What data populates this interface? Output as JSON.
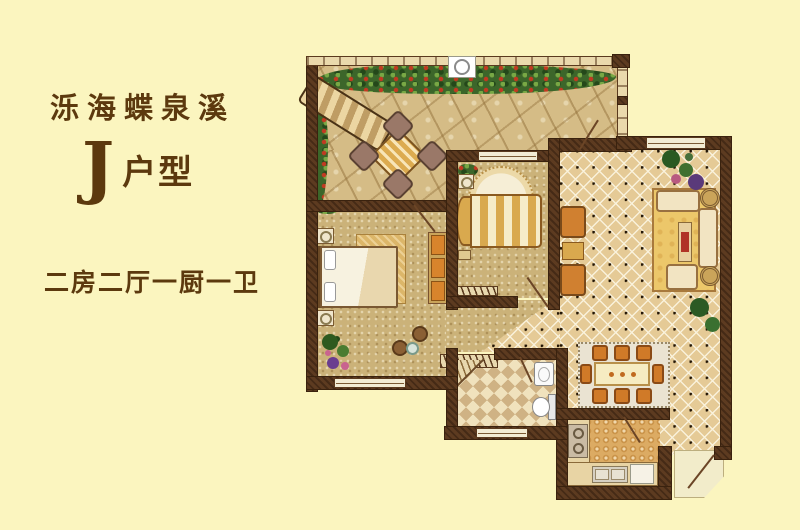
{
  "panel": {
    "project_name": "泺海蝶泉溪",
    "unit_letter": "J",
    "unit_suffix": "户型",
    "description": "二房二厅一厨一卫"
  },
  "colors": {
    "background": "#fbf5bf",
    "text": "#5c390e",
    "wall": "#5d3b20",
    "terrace_floor": "#d5bc86",
    "bedroom_floor": "#cbb279",
    "living_tile": "#e5ca96",
    "bathroom_tile_dark": "#cfb284",
    "bathroom_tile_light": "#f0e2bd",
    "kitchen_floor": "#dcab63",
    "hedge_green": "#3c662a",
    "flower_red": "#c23a22",
    "furniture_gold": "#d9a94e",
    "chair_orange": "#d07a28",
    "rug_red_accent": "#b03226",
    "plant_purple": "#6a3d8f",
    "plant_pink": "#c9648f"
  },
  "floorplan": {
    "rooms": [
      {
        "id": "terrace"
      },
      {
        "id": "master-bedroom"
      },
      {
        "id": "second-bedroom"
      },
      {
        "id": "living-room"
      },
      {
        "id": "dining-area"
      },
      {
        "id": "corridor"
      },
      {
        "id": "bathroom"
      },
      {
        "id": "kitchen"
      },
      {
        "id": "entry"
      }
    ],
    "furniture": [
      "hedge-with-red-flowers",
      "lounge-chair",
      "patio-table-4-chairs",
      "terrace-column",
      "double-bed",
      "nightstands",
      "wardrobe",
      "ottomans",
      "potted-plants",
      "single-bed",
      "round-rug",
      "radiator-cabinets",
      "sofa-set",
      "area-rug",
      "coffee-table",
      "side-tables",
      "armchairs",
      "dining-table-8-chairs",
      "corner-shower",
      "wash-basin",
      "toilet",
      "stove",
      "kitchen-counter",
      "kitchen-sink",
      "fridge",
      "entry-door"
    ]
  }
}
